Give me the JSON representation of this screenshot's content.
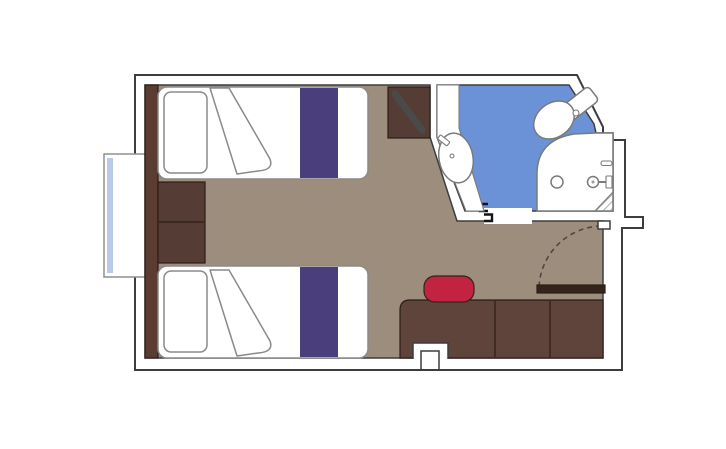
{
  "meta": {
    "description": "Cruise ship cabin floor plan: two twin beds with purple bed runners, wardrobe panel and nightstand on the left, TV corner unit, en-suite bathroom with sink, toilet and shower on blue flooring, desk row with red stool, and entrance door with swing arc at lower right",
    "plan_type": "cabin-floor-plan"
  },
  "elements": {
    "window": "panoramic window bay",
    "headboard_panel": "wood headboard panel along left wall",
    "nightstand": "two-drawer nightstand between beds",
    "bed_top": "twin bed (upper)",
    "bed_bottom": "twin bed (lower)",
    "tv_unit": "corner TV cabinet with angled screen",
    "bathroom": "en-suite bathroom",
    "sink": "washbasin on vanity",
    "toilet": "toilet",
    "shower": "shower enclosure with drain and mixer",
    "desk": "desk / cabinet row",
    "stool": "red stool",
    "entrance_door": "entrance door with swing arc",
    "service_notch": "structural recess in bottom wall"
  },
  "colors": {
    "background": "#ffffff",
    "wall_fill": "#ffffff",
    "wall_outline": "#3d3d3d",
    "floor": "#9c8d7d",
    "bathroom_floor": "#6b92d6",
    "fixture_fill": "#ffffff",
    "bed_fill": "#ffffff",
    "bed_stripe": "#4a3f7c",
    "headboard_wood": "#5a3c31",
    "cabinet_wood": "#553c34",
    "desk_wood": "#5e443a",
    "door_wood": "#342419",
    "stool_red": "#c22340",
    "window_glass": "#b9c9e9",
    "tv_screen": "#4a4a4a",
    "swing_arc": "#55463c",
    "hatch": "#9a9a9a",
    "threshold": "#ffffff"
  }
}
